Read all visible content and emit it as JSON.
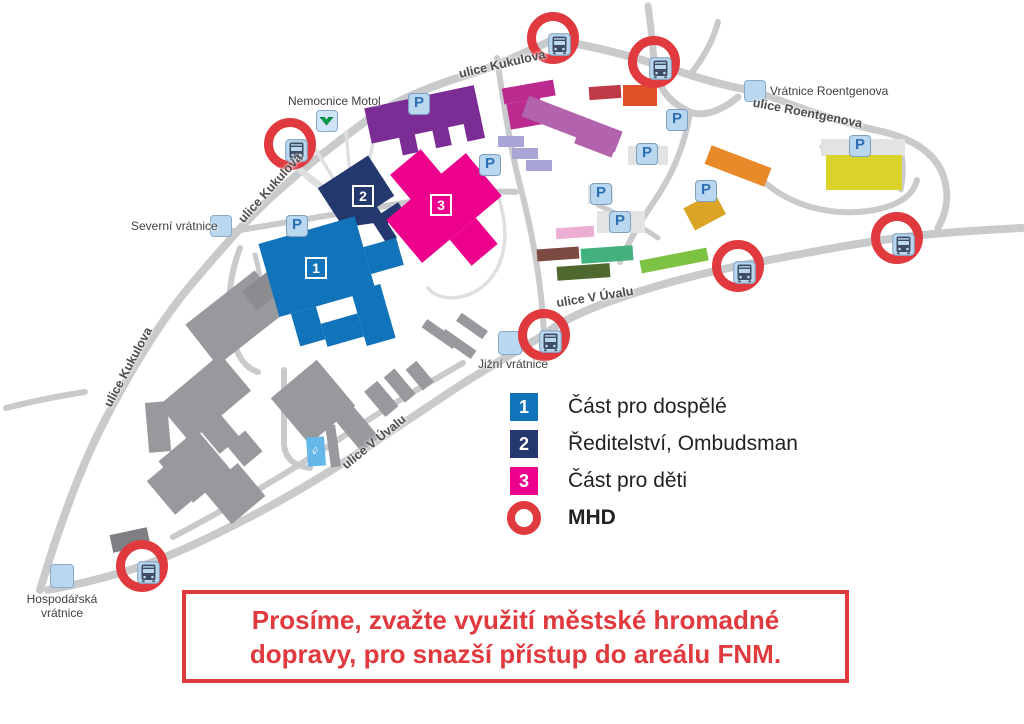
{
  "map": {
    "station_label": "Nemocnice Motol",
    "streets": {
      "kukulova": "ulice Kukulova",
      "roentgenova": "ulice Roentgenova",
      "v_uvalu": "ulice V Úvalu"
    },
    "gates": {
      "severni": "Severní vrátnice",
      "roentgenova": "Vrátnice Roentgenova",
      "jizni": "Jižní vrátnice",
      "hospodarska": "Hospodářská vrátnice"
    },
    "parking_symbol": "P",
    "small_building_label": "47",
    "markers": {
      "adults": "1",
      "directorate": "2",
      "children": "3"
    }
  },
  "legend": {
    "items": [
      {
        "marker": "1",
        "label": "Část pro dospělé",
        "color": "#1173b9"
      },
      {
        "marker": "2",
        "label": "Ředitelství, Ombudsman",
        "color": "#24386f"
      },
      {
        "marker": "3",
        "label": "Část pro děti",
        "color": "#ec008c"
      },
      {
        "marker": "ring",
        "label": "MHD",
        "color": "#e0393e"
      }
    ]
  },
  "notice": {
    "line1": "Prosíme, zvažte využití městské hromadné",
    "line2": "dopravy, pro snazší přístup do areálu FNM.",
    "color": "#e0393e"
  },
  "colors": {
    "road": "#c9cacc",
    "mhd_ring": "#e0393e",
    "icon_bg": "#b9d7ef",
    "metro_green": "#009e49"
  }
}
